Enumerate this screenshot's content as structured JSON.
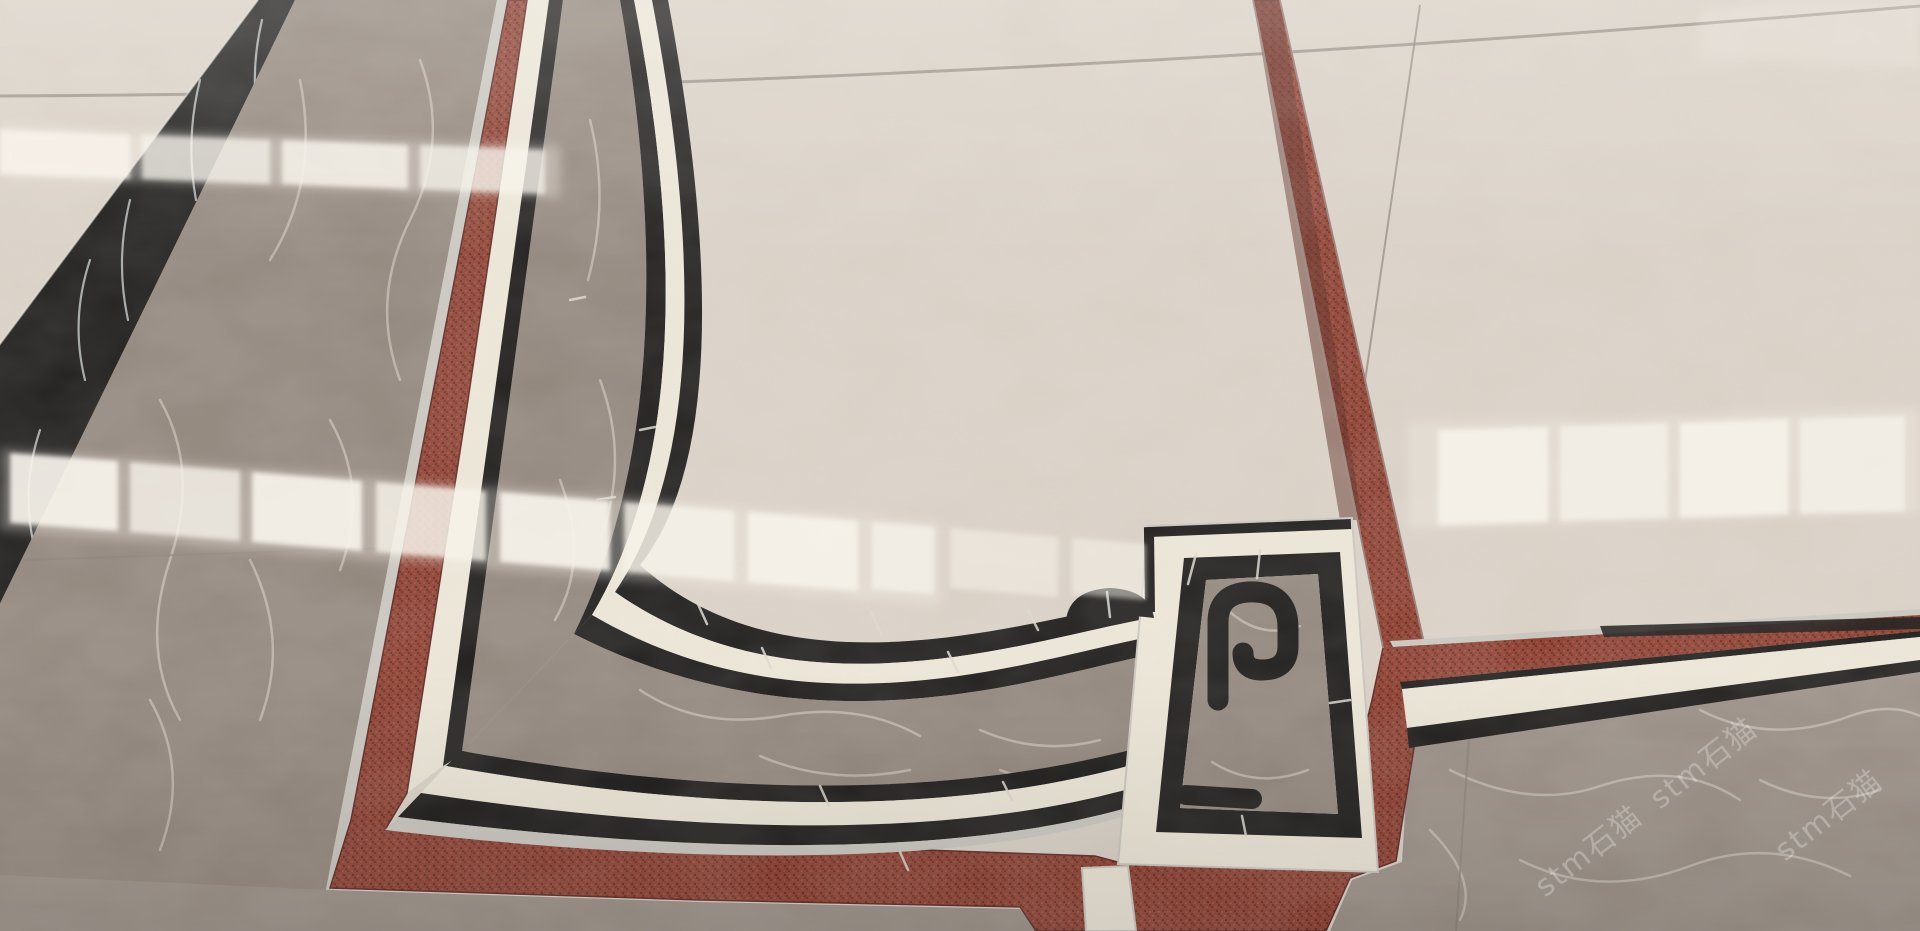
{
  "scene": {
    "description": "Close-up oblique photograph of polished marble show-floor panels: a beige marble field framed by a waterjet-cut decorative border of black marble pinstripes and cream marble bands around a wide grey marble band, with a Greek-key scroll corner medallion set on a grey marble square. Panels are separated by recessed red coir matting channels with aluminium edge trim; bright window reflections streak across the polished surface.",
    "camera": "wide-angle phone shot looking down and forward across the floor"
  },
  "materials": {
    "beige_field": {
      "label": "Beige polished marble field tile",
      "color": "#d7cec3"
    },
    "cream_band": {
      "label": "Cream marble border band",
      "color": "#eae3d4"
    },
    "black_inlay": {
      "label": "Black marble inlay pinstripe",
      "color": "#161514"
    },
    "grey_marble": {
      "label": "Grey-brown marble border band",
      "color": "#8e8278"
    },
    "grey_field": {
      "label": "Grey-brown marble field",
      "color": "#978c83"
    },
    "red_coir": {
      "label": "Red coir matting channel",
      "color": "#8a3a2c"
    },
    "metal_edge": {
      "label": "Aluminium panel edge trim",
      "color": "#c6c3bc"
    },
    "white_vein": {
      "label": "White marble veining",
      "color": "#d9d2c7"
    },
    "reflection_white": {
      "label": "Window reflection highlight",
      "color": "#f7f3eb"
    },
    "tile_joint": {
      "label": "Tile joint line",
      "color": "#857b72"
    }
  },
  "border_sequence_outer_to_inner": [
    "red coir channel",
    "aluminium edge trim",
    "black pinstripe",
    "cream marble band",
    "black pinstripe",
    "wide grey marble band",
    "black pinstripe",
    "cream marble band",
    "black pinstripe",
    "beige marble field"
  ],
  "corner_medallion": {
    "label": "Greek-key scroll corner medallion",
    "outer_wrap": "cream marble square",
    "outer_ring": "black marble square ring",
    "inner_square": "grey marble",
    "motif": "black scroll volute (Greek key) with cream gaps",
    "accent": "black half-dome boss on the inner pinstripe beside the medallion"
  },
  "watermark": {
    "text": "stm石猫",
    "instances": 3,
    "style": "white translucent, rotated diagonally, bottom right"
  },
  "lighting": {
    "reflections": "rows of bright reflected window panes across the polished marble",
    "vignette": "brighter at top, slightly darker toward bottom"
  }
}
